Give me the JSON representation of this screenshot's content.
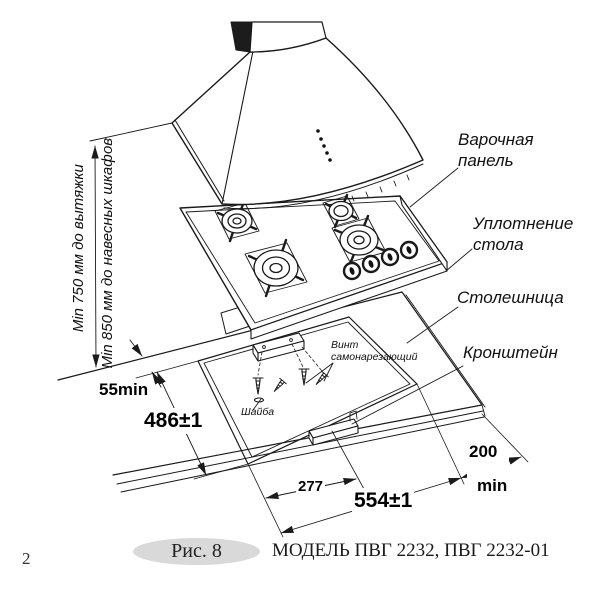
{
  "page_number": "2",
  "figure": {
    "tag": "Рис. 8",
    "caption": "МОДЕЛЬ ПВГ 2232, ПВГ 2232-01"
  },
  "callouts": {
    "hob": "Варочная\nпанель",
    "seal": "Уплотнение\nстола",
    "countertop": "Столешница",
    "bracket": "Кронштейн",
    "screw": "Винт\nсамонарезающий",
    "washer": "Шайба"
  },
  "dimensions": {
    "hood_clearance": "Min 750 мм до вытяжки",
    "cabinet_clearance": "Min 850 мм до навесных шкафов",
    "edge_offset": "55min",
    "cutout_depth": "486±1",
    "center_offset": "277",
    "cutout_width": "554±1",
    "side_clearance_value": "200",
    "side_clearance_unit": "min"
  },
  "colors": {
    "line": "#1a1a1a",
    "figure_ellipse": "#d9d9d9",
    "paper": "#ffffff"
  }
}
